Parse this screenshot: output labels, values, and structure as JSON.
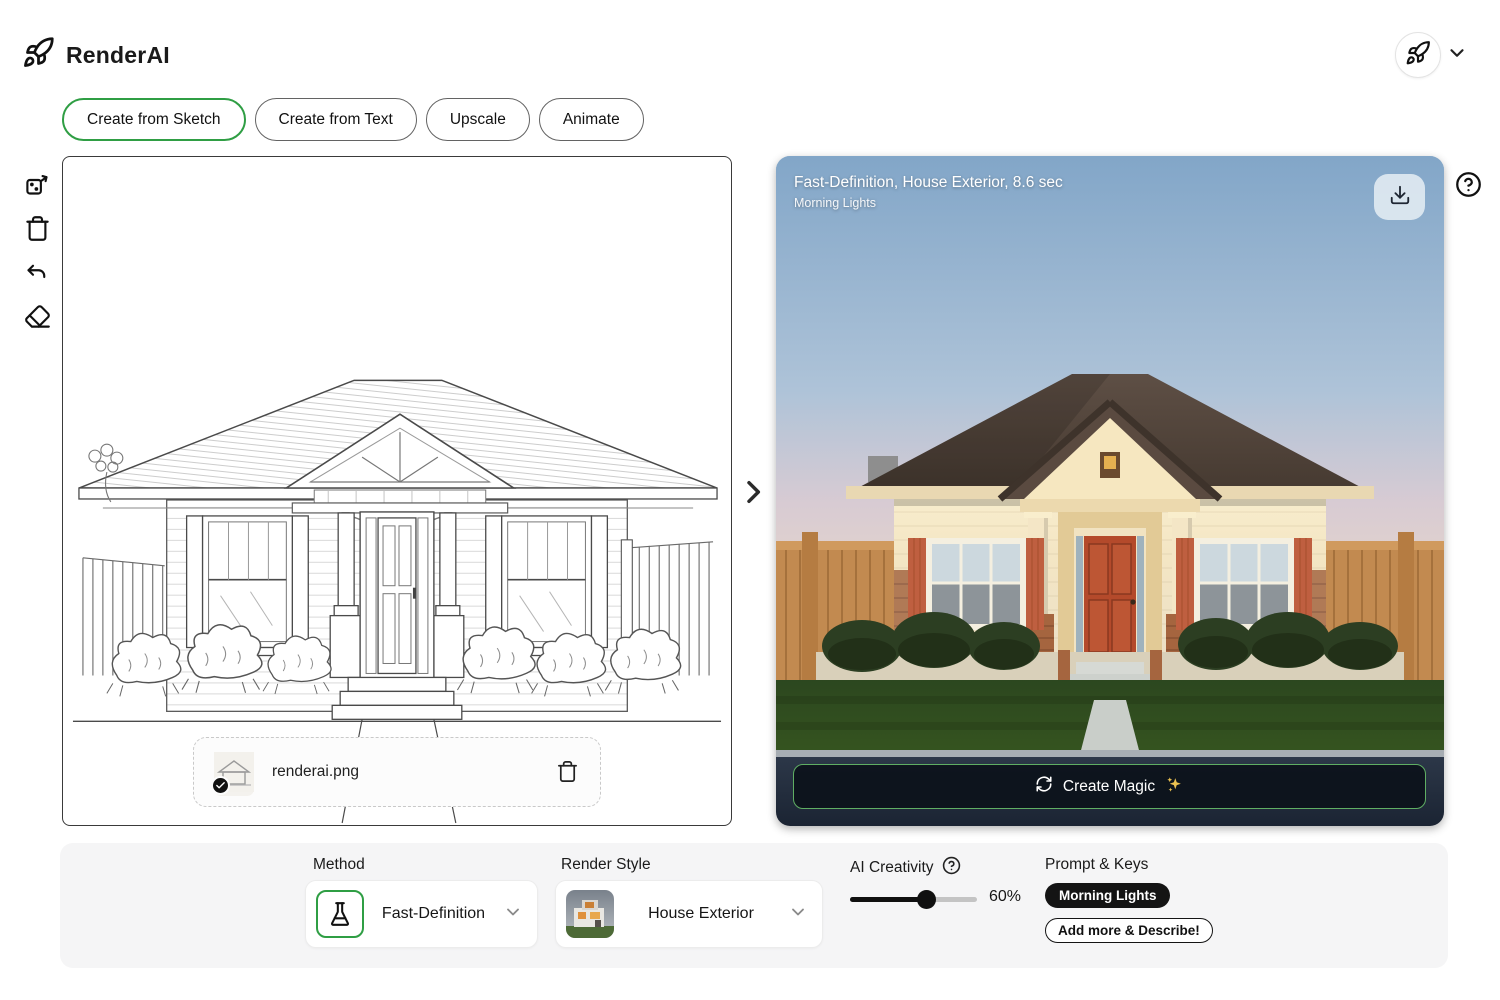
{
  "colors": {
    "accent_green": "#2f9e44",
    "button_border": "#5fae63",
    "key_pill_bg": "#141414",
    "panel_border": "#3a3a3a"
  },
  "header": {
    "app_name": "RenderAI",
    "logo_icon": "rocket-icon",
    "account_icon": "rocket-icon",
    "account_chevron": "chevron-down-icon"
  },
  "tabs": [
    {
      "label": "Create from Sketch",
      "active": true
    },
    {
      "label": "Create from Text",
      "active": false
    },
    {
      "label": "Upscale",
      "active": false
    },
    {
      "label": "Animate",
      "active": false
    }
  ],
  "toolbar": {
    "icons": [
      "randomize-icon",
      "trash-icon",
      "undo-icon",
      "eraser-icon"
    ]
  },
  "sketch_panel": {
    "file_chip": {
      "filename": "renderai.png",
      "status_icon": "check-icon",
      "delete_icon": "trash-icon"
    }
  },
  "divider": {
    "icon": "chevron-right-icon"
  },
  "result_panel": {
    "title": "Fast-Definition, House Exterior, 8.6 sec",
    "subtitle": "Morning Lights",
    "download_icon": "download-icon",
    "help_icon": "question-icon",
    "create_button": {
      "label": "Create Magic",
      "left_icon": "refresh-icon",
      "right_icon": "sparkles-icon"
    }
  },
  "settings": {
    "method": {
      "label": "Method",
      "value": "Fast-Definition",
      "icon": "flask-icon"
    },
    "render_style": {
      "label": "Render Style",
      "value": "House Exterior",
      "thumbnail": "modern-house-thumbnail"
    },
    "creativity": {
      "label": "AI Creativity",
      "help_icon": "question-icon",
      "value_pct": 60,
      "display": "60%"
    },
    "prompt": {
      "label": "Prompt & Keys",
      "keys": [
        "Morning Lights"
      ],
      "add_label": "Add more & Describe!"
    }
  }
}
